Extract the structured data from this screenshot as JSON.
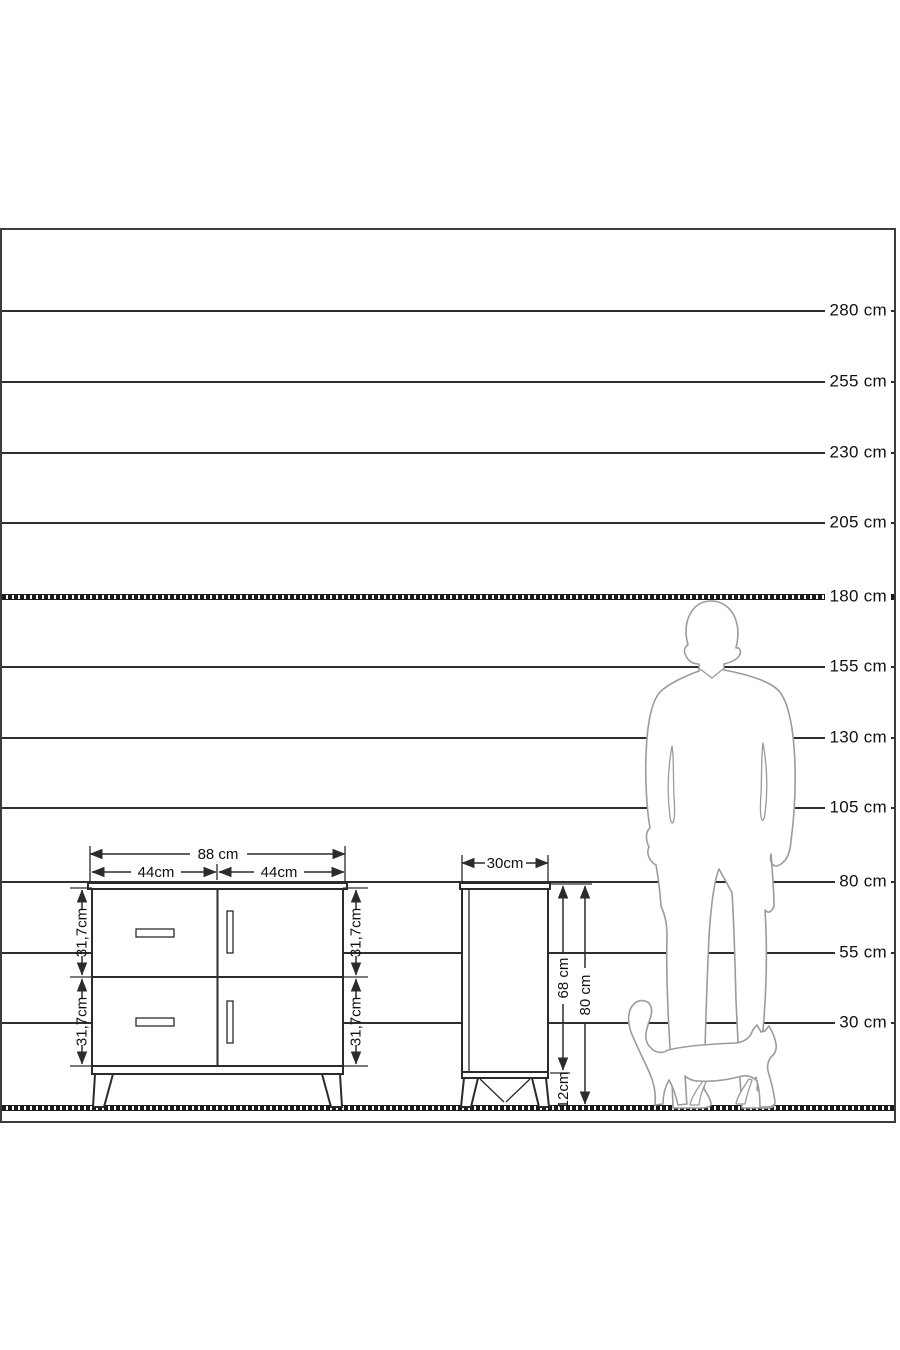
{
  "palette": {
    "ink": "#2b2b2b",
    "frame_border": "#3c3c3c",
    "silhouette_outline": "#9b9b9b",
    "background": "#ffffff"
  },
  "scale": {
    "unit": "cm",
    "labels": [
      "280 cm",
      "255 cm",
      "230 cm",
      "205 cm",
      "180 cm",
      "155 cm",
      "130 cm",
      "105 cm",
      "80 cm",
      "55 cm",
      "30 cm"
    ]
  },
  "front_view": {
    "width": "88 cm",
    "left_half": "44cm",
    "right_half": "44cm",
    "height_top_left": "31,7cm",
    "height_bottom_left": "31,7cm",
    "height_top_right": "31,7cm",
    "height_bottom_right": "31,7cm"
  },
  "side_view": {
    "depth": "30cm",
    "body_height": "68 cm",
    "total_height": "80 cm",
    "leg_height": "12cm"
  }
}
